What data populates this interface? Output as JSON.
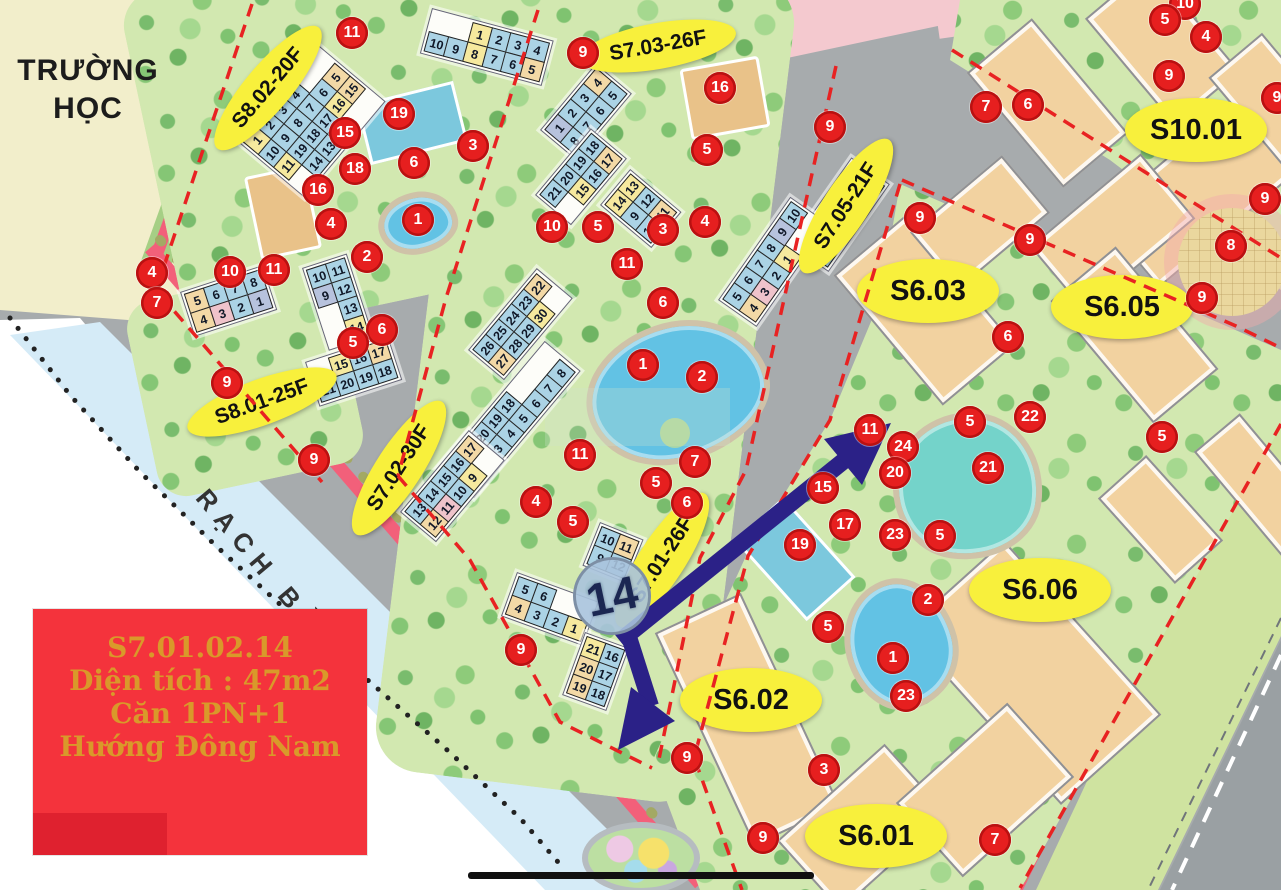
{
  "map": {
    "place_labels": {
      "school_line1": "TRƯỜNG",
      "school_line2": "HỌC",
      "canal": "RẠCH BÀ DÌ"
    },
    "info_box": {
      "lines": [
        "S7.01.02.14",
        "Diện tích : 47m2",
        "Căn 1PN+1",
        "Hướng Đông Nam"
      ]
    },
    "big_marker": {
      "text": "14",
      "x": 612,
      "y": 596
    },
    "region_labels": [
      {
        "text": "S8.02-20F",
        "x": 268,
        "y": 88,
        "rot": -50,
        "size": "s"
      },
      {
        "text": "S7.03-26F",
        "x": 658,
        "y": 46,
        "rot": -10,
        "size": "s"
      },
      {
        "text": "S7.05-21F",
        "x": 846,
        "y": 206,
        "rot": -57,
        "size": "s"
      },
      {
        "text": "S7.02-30F",
        "x": 399,
        "y": 468,
        "rot": -57,
        "size": "s"
      },
      {
        "text": "S8.01-25F",
        "x": 262,
        "y": 402,
        "rot": -20,
        "size": "s"
      },
      {
        "text": "S7.01-26F",
        "x": 662,
        "y": 560,
        "rot": -57,
        "size": "s"
      },
      {
        "text": "S10.01",
        "x": 1196,
        "y": 130,
        "rot": 0,
        "size": "l"
      },
      {
        "text": "S6.03",
        "x": 928,
        "y": 291,
        "rot": 0,
        "size": "l"
      },
      {
        "text": "S6.05",
        "x": 1122,
        "y": 307,
        "rot": 0,
        "size": "l"
      },
      {
        "text": "S6.06",
        "x": 1040,
        "y": 590,
        "rot": 0,
        "size": "l"
      },
      {
        "text": "S6.02",
        "x": 751,
        "y": 700,
        "rot": 0,
        "size": "l"
      },
      {
        "text": "S6.01",
        "x": 876,
        "y": 836,
        "rot": 0,
        "size": "l"
      }
    ],
    "markers": [
      {
        "n": "11",
        "x": 352,
        "y": 33
      },
      {
        "n": "9",
        "x": 583,
        "y": 53
      },
      {
        "n": "16",
        "x": 720,
        "y": 88
      },
      {
        "n": "19",
        "x": 399,
        "y": 114
      },
      {
        "n": "15",
        "x": 345,
        "y": 133
      },
      {
        "n": "3",
        "x": 473,
        "y": 146
      },
      {
        "n": "5",
        "x": 707,
        "y": 150
      },
      {
        "n": "6",
        "x": 414,
        "y": 163
      },
      {
        "n": "18",
        "x": 355,
        "y": 169
      },
      {
        "n": "16",
        "x": 318,
        "y": 190
      },
      {
        "n": "1",
        "x": 418,
        "y": 220
      },
      {
        "n": "4",
        "x": 331,
        "y": 224
      },
      {
        "n": "10",
        "x": 552,
        "y": 227
      },
      {
        "n": "5",
        "x": 598,
        "y": 227
      },
      {
        "n": "3",
        "x": 663,
        "y": 230
      },
      {
        "n": "4",
        "x": 705,
        "y": 222
      },
      {
        "n": "2",
        "x": 367,
        "y": 257
      },
      {
        "n": "11",
        "x": 274,
        "y": 270
      },
      {
        "n": "10",
        "x": 230,
        "y": 272
      },
      {
        "n": "4",
        "x": 152,
        "y": 273
      },
      {
        "n": "11",
        "x": 627,
        "y": 264
      },
      {
        "n": "6",
        "x": 663,
        "y": 303
      },
      {
        "n": "7",
        "x": 157,
        "y": 303
      },
      {
        "n": "6",
        "x": 382,
        "y": 330
      },
      {
        "n": "5",
        "x": 353,
        "y": 343
      },
      {
        "n": "1",
        "x": 643,
        "y": 365
      },
      {
        "n": "2",
        "x": 702,
        "y": 377
      },
      {
        "n": "9",
        "x": 227,
        "y": 383
      },
      {
        "n": "11",
        "x": 580,
        "y": 455
      },
      {
        "n": "9",
        "x": 314,
        "y": 460
      },
      {
        "n": "7",
        "x": 695,
        "y": 462
      },
      {
        "n": "5",
        "x": 656,
        "y": 483
      },
      {
        "n": "6",
        "x": 687,
        "y": 503
      },
      {
        "n": "4",
        "x": 536,
        "y": 502
      },
      {
        "n": "5",
        "x": 573,
        "y": 522
      },
      {
        "n": "9",
        "x": 521,
        "y": 650
      },
      {
        "n": "9",
        "x": 687,
        "y": 758
      },
      {
        "n": "9",
        "x": 830,
        "y": 127
      },
      {
        "n": "9",
        "x": 920,
        "y": 218
      },
      {
        "n": "9",
        "x": 1030,
        "y": 240
      },
      {
        "n": "10",
        "x": 1185,
        "y": 4
      },
      {
        "n": "5",
        "x": 1165,
        "y": 20
      },
      {
        "n": "4",
        "x": 1206,
        "y": 37
      },
      {
        "n": "9",
        "x": 1169,
        "y": 76
      },
      {
        "n": "7",
        "x": 986,
        "y": 107
      },
      {
        "n": "6",
        "x": 1028,
        "y": 105
      },
      {
        "n": "9",
        "x": 1277,
        "y": 98
      },
      {
        "n": "9",
        "x": 1265,
        "y": 199
      },
      {
        "n": "8",
        "x": 1231,
        "y": 246
      },
      {
        "n": "9",
        "x": 1202,
        "y": 298
      },
      {
        "n": "6",
        "x": 1008,
        "y": 337
      },
      {
        "n": "5",
        "x": 970,
        "y": 422
      },
      {
        "n": "22",
        "x": 1030,
        "y": 417
      },
      {
        "n": "21",
        "x": 988,
        "y": 468
      },
      {
        "n": "5",
        "x": 1162,
        "y": 437
      },
      {
        "n": "11",
        "x": 870,
        "y": 430
      },
      {
        "n": "24",
        "x": 903,
        "y": 447
      },
      {
        "n": "20",
        "x": 895,
        "y": 473
      },
      {
        "n": "15",
        "x": 823,
        "y": 488
      },
      {
        "n": "17",
        "x": 845,
        "y": 525
      },
      {
        "n": "19",
        "x": 800,
        "y": 545
      },
      {
        "n": "23",
        "x": 895,
        "y": 535
      },
      {
        "n": "5",
        "x": 940,
        "y": 536
      },
      {
        "n": "2",
        "x": 928,
        "y": 600
      },
      {
        "n": "5",
        "x": 828,
        "y": 627
      },
      {
        "n": "1",
        "x": 893,
        "y": 658
      },
      {
        "n": "23",
        "x": 906,
        "y": 696
      },
      {
        "n": "3",
        "x": 824,
        "y": 770
      },
      {
        "n": "9",
        "x": 763,
        "y": 838
      },
      {
        "n": "7",
        "x": 995,
        "y": 840
      }
    ],
    "unit_grids": [
      {
        "x": 432,
        "y": 8,
        "rot": 15,
        "rows": [
          [
            "",
            "",
            "1y",
            "2b",
            "3b",
            "4b"
          ],
          [
            "10b",
            "9b",
            "8y",
            "7b",
            "6b",
            "5t"
          ]
        ]
      },
      {
        "x": 238,
        "y": 142,
        "rot": -50,
        "rows": [
          [
            "1y",
            "2b",
            "3b",
            "4b"
          ],
          [
            "10b",
            "9b",
            "8b",
            "7b",
            "6b",
            "5t"
          ],
          [
            "11y",
            "19b",
            "18b",
            "17b",
            "16y",
            "15t"
          ],
          [
            "",
            "14b",
            "13b",
            "12b"
          ]
        ]
      },
      {
        "x": 180,
        "y": 292,
        "rot": -18,
        "rows": [
          [
            "5t",
            "6b",
            "7b",
            "8b"
          ],
          [
            "4t",
            "3p",
            "2b",
            "1l"
          ]
        ]
      },
      {
        "x": 302,
        "y": 268,
        "rot": -18,
        "rows": [
          [
            "10b",
            "11b"
          ],
          [
            "9l",
            "12b"
          ],
          [
            "",
            "13b"
          ],
          [
            "",
            "14y"
          ]
        ]
      },
      {
        "x": 305,
        "y": 362,
        "rot": -18,
        "rows": [
          [
            "",
            "15y",
            "16b",
            "17t"
          ],
          [
            "21b",
            "20b",
            "19b",
            "18b"
          ]
        ]
      },
      {
        "x": 540,
        "y": 130,
        "rot": -50,
        "rows": [
          [
            "1l",
            "2b",
            "3b",
            "4t"
          ],
          [
            "8b",
            "7b",
            "6b",
            "5b"
          ]
        ]
      },
      {
        "x": 535,
        "y": 195,
        "rot": -50,
        "rows": [
          [
            "21b",
            "20b",
            "19b",
            "18b"
          ],
          [
            "",
            "15y",
            "16b",
            "17t"
          ]
        ]
      },
      {
        "x": 600,
        "y": 205,
        "rot": -50,
        "rows": [
          [
            "14y",
            "13y"
          ],
          [
            "9b",
            "12b"
          ],
          [
            "10b",
            "11t"
          ]
        ]
      },
      {
        "x": 468,
        "y": 350,
        "rot": -50,
        "rows": [
          [
            "26b",
            "25b",
            "24b",
            "23b",
            "22t"
          ],
          [
            "27t",
            "28b",
            "29b",
            "30y"
          ]
        ]
      },
      {
        "x": 438,
        "y": 468,
        "rot": -50,
        "rows": [
          [
            "",
            "21b",
            "20b",
            "19b",
            "18b"
          ],
          [
            "1y",
            "2b",
            "3b",
            "4b",
            "5b",
            "6b",
            "7b",
            "8b"
          ]
        ]
      },
      {
        "x": 400,
        "y": 512,
        "rot": -50,
        "rows": [
          [
            "13b",
            "14b",
            "15b",
            "16b",
            "17t"
          ],
          [
            "12t",
            "11p",
            "10b",
            "9y"
          ]
        ]
      },
      {
        "x": 790,
        "y": 245,
        "rot": -55,
        "rows": [
          [
            "11y",
            "12b",
            "13b",
            "14b"
          ],
          [
            "19b",
            "18b",
            "17b",
            "16b",
            "15b"
          ]
        ]
      },
      {
        "x": 718,
        "y": 300,
        "rot": -55,
        "rows": [
          [
            "5b",
            "6b",
            "7b",
            "8b",
            "9l",
            "10b"
          ],
          [
            "4t",
            "3p",
            "2b",
            "1y"
          ]
        ]
      },
      {
        "x": 600,
        "y": 522,
        "rot": 22,
        "rows": [
          [
            "10b",
            "11t"
          ],
          [
            "9b",
            "12b"
          ]
        ]
      },
      {
        "x": 517,
        "y": 572,
        "rot": 20,
        "rows": [
          [
            "5b",
            "6b"
          ],
          [
            "4t",
            "3b",
            "2b",
            "1y"
          ]
        ]
      },
      {
        "x": 585,
        "y": 632,
        "rot": 20,
        "rows": [
          [
            "21y",
            "16b"
          ],
          [
            "20t",
            "17b"
          ],
          [
            "19t",
            "18b"
          ]
        ]
      }
    ]
  },
  "colors": {
    "marker_red": "#e61f1f",
    "oval_yellow": "#f8f03c",
    "arrow_navy": "#2b2187",
    "info_bg": "#f4333c",
    "info_text": "#d9992a",
    "boundary_red_dash": "#e82222",
    "canal_blue": "#d5ebf7",
    "building_tan": "#f2d2a0"
  }
}
